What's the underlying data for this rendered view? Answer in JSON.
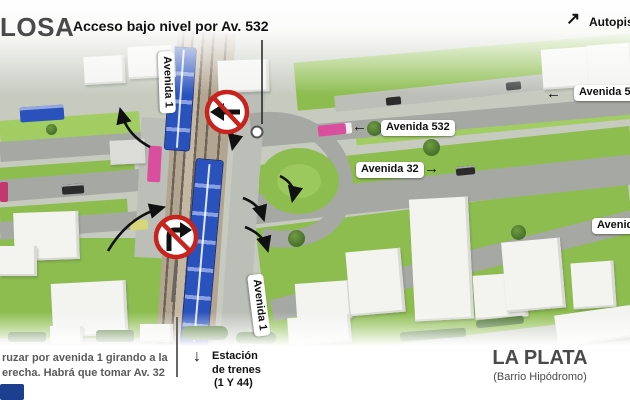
{
  "colors": {
    "ground": "#c6cabf",
    "grass": "#8dbd4f",
    "grass_light": "#a2cd63",
    "hedge": "#47702c",
    "road": "#a6a8a3",
    "road_light": "#bcbfb8",
    "rail": "#b2a591",
    "rail_dark": "#6e6455",
    "train_blue": "#2a52bd",
    "train_stripe": "#8aa2e4",
    "sign_red": "#c9231d",
    "magenta": "#d94f9e",
    "yellow": "#d6d77a",
    "navy": "#1d3f8f",
    "car_dark": "#2b2b2b",
    "label_bg": "#ffffff",
    "ink": "#111111",
    "muted": "#5a5a5a",
    "building": "#f3f3f0",
    "building_shade": "#d9d9d5"
  },
  "icons": {
    "arrow_up_right": "↗",
    "arrow_down": "↓",
    "arrow_left": "←",
    "arrow_right": "→"
  },
  "header": {
    "district": "LOSA",
    "title": "Acceso bajo nivel por Av. 532",
    "autopista": "Autopista"
  },
  "roads": {
    "av532_far": "Avenida 532",
    "av532": "Avenida 532",
    "av32": "Avenida 32",
    "av_edge": "Avenida",
    "av1_top": "Avenida 1",
    "av1_bottom": "Avenida 1"
  },
  "footer": {
    "note_line1": "ruzar por avenida 1 girando a la",
    "note_line2": "erecha. Habrá que tomar Av. 32",
    "station": {
      "line1": "Estación",
      "line2": "de trenes",
      "line3": "(1 Y 44)"
    },
    "city": "LA PLATA",
    "city_sub": "(Barrio Hipódromo)"
  }
}
